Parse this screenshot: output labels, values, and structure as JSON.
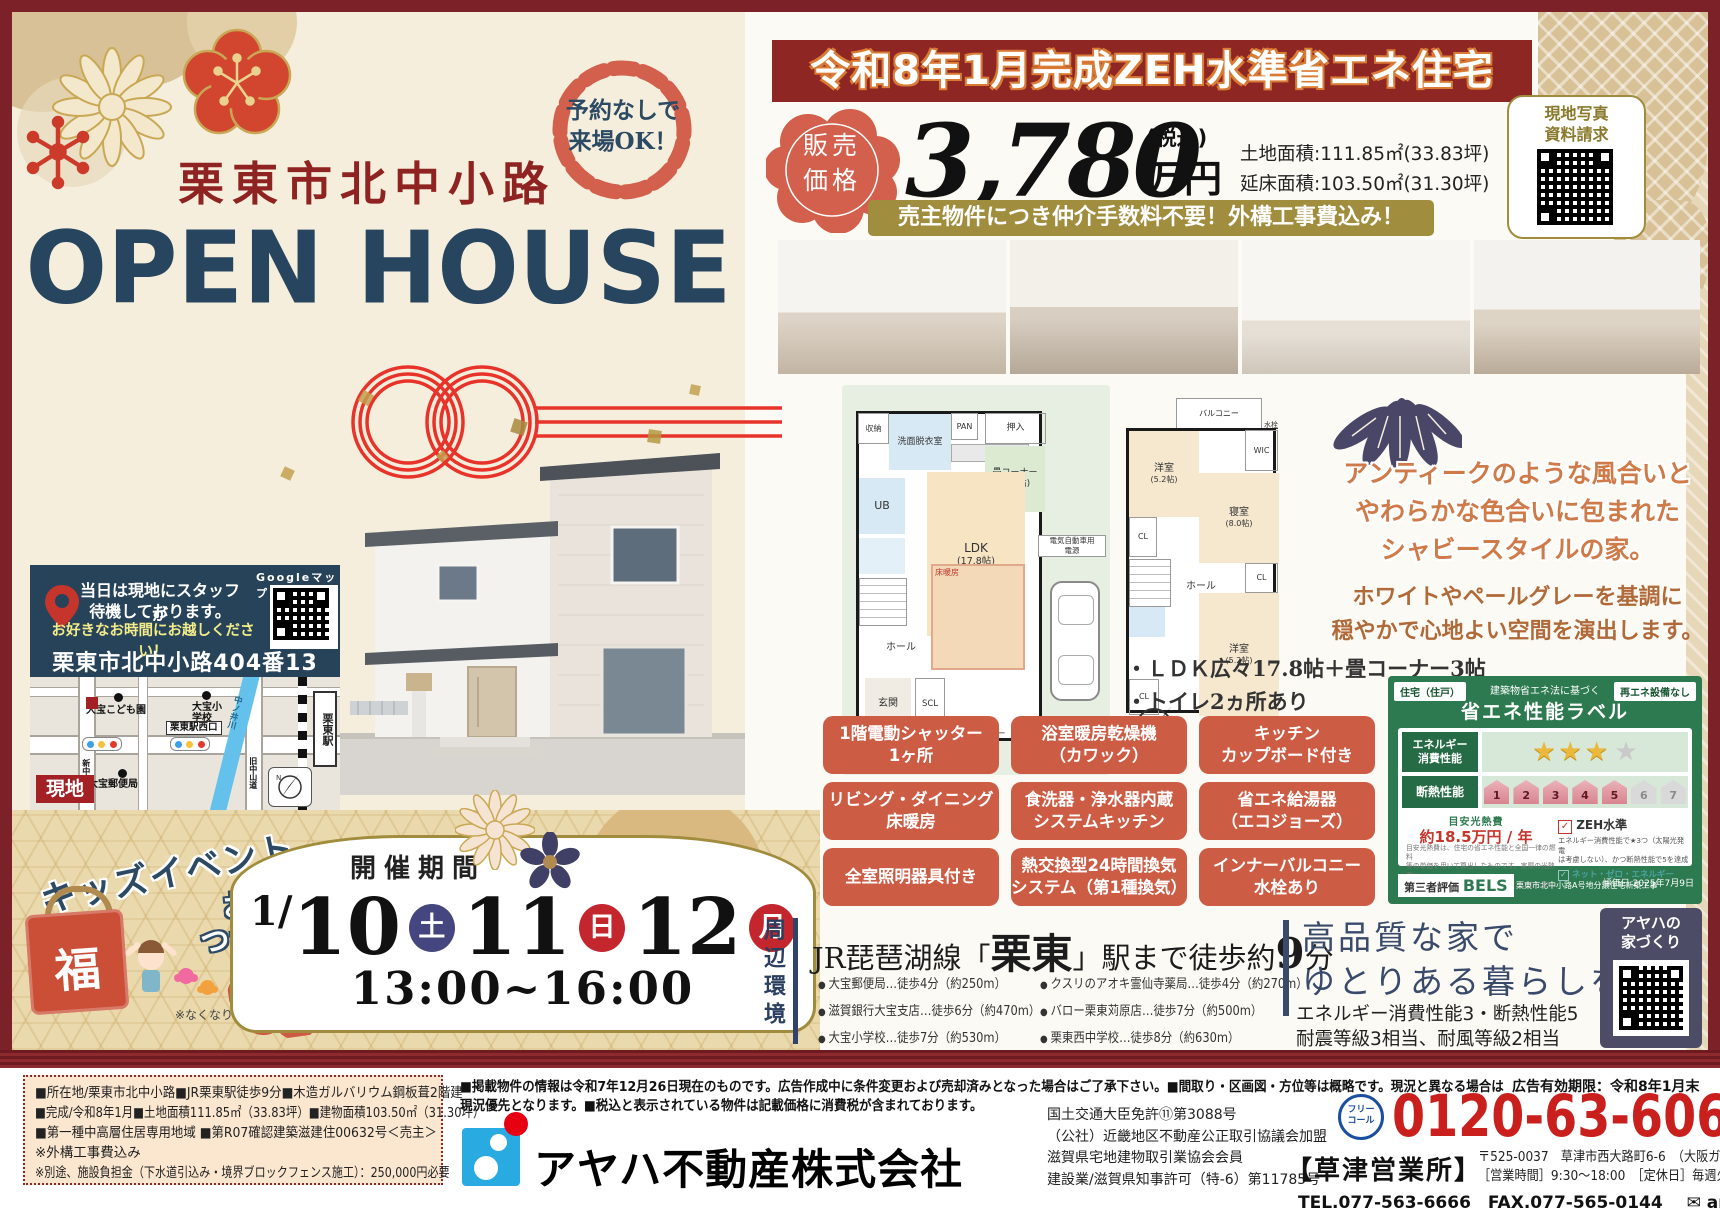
{
  "colors": {
    "frame": "#7c2128",
    "banner_red": "#8e2723",
    "navy": "#29445c",
    "terracotta": "#cd5c45",
    "gold": "#a08c3c",
    "cream": "#f5eedd",
    "label_green": "#2e7a50",
    "phone_red": "#c9201e"
  },
  "left": {
    "badge": {
      "line1": "予約なしで",
      "line2": "来場OK！"
    },
    "location_title": "栗東市北中小路",
    "main_title": "OPEN HOUSE",
    "site_box": {
      "staff1": "当日は現地にスタッフが",
      "staff2": "待機しております。",
      "staff3": "お好きなお時間にお越しください！",
      "address": "栗東市北中小路404番13",
      "google_label": "Googleマップ"
    },
    "map": {
      "kodomoen": "大宝こども園",
      "elementary": "大宝小学校",
      "west_exit": "栗東駅西口",
      "river": "中ノ井川",
      "station": "栗東駅",
      "shin_road": "新中山道",
      "kyu_road": "旧中山道",
      "post_office": "大宝郵便局",
      "genchi": "現地"
    },
    "kids": {
      "title": "キッズイベント",
      "sub1": "お菓子の",
      "sub2": "つかみ取り",
      "fuku": "福",
      "badge1": "3日間",
      "badge2": "限定",
      "note": "※なくなり次第終了となります。"
    },
    "schedule": {
      "heading": "開催期間",
      "month": "1/",
      "d1": "10",
      "w1": "土",
      "d2": "11",
      "w2": "日",
      "d3": "12",
      "w3": "月",
      "time": "13:00~16:00"
    }
  },
  "right": {
    "banner": "令和8年1月完成ZEH水準省エネ住宅",
    "price": {
      "label1": "販売",
      "label2": "価格",
      "amount": "3,780",
      "tax": "(税込)",
      "unit": "万円",
      "land": "土地面積:111.85㎡(33.83坪)",
      "floor": "延床面積:103.50㎡(31.30坪)"
    },
    "qr_card": {
      "line1": "現地写真",
      "line2": "資料請求"
    },
    "gold_banner": "売主物件につき仲介手数料不要！外構工事費込み！",
    "plan1f": {
      "storage": "収納",
      "wash": "洗面脱衣室",
      "pan": "PAN",
      "ub": "UB",
      "tatami1": "畳コーナー",
      "tatami2": "(3.0帖)",
      "ldk1": "LDK",
      "ldk2": "(17.8帖)",
      "yukadan": "床暖房",
      "oshiire": "押入",
      "hall": "ホール",
      "genkan": "玄関",
      "scl": "SCL",
      "shutter": "電動シャッター",
      "ev1": "電気自動車用",
      "ev2": "電源"
    },
    "plan2f": {
      "balcony": "バルコニー",
      "suisen": "水栓",
      "wic": "WIC",
      "yo1a": "洋室",
      "yo1b": "(5.2帖)",
      "bed1": "寝室",
      "bed2": "(8.0帖)",
      "cl": "CL",
      "hall": "ホール",
      "yo2a": "洋室",
      "yo2b": "(5.2帖)"
    },
    "catch": {
      "l1": "アンティークのような風合いと",
      "l2": "やわらかな色合いに包まれた",
      "l3": "シャビースタイルの家。",
      "s1": "ホワイトやペールグレーを基調に",
      "s2": "穏やかで心地よい空間を演出します。"
    },
    "points": {
      "p1": "・ＬＤＫ広々17.8帖＋畳コーナー3帖",
      "p2": "・トイレ2ヵ所あり"
    },
    "features": [
      {
        "l1": "1階電動シャッター",
        "l2": "1ヶ所"
      },
      {
        "l1": "浴室暖房乾燥機",
        "l2": "（カワック）"
      },
      {
        "l1": "キッチン",
        "l2": "カップボード付き"
      },
      {
        "l1": "リビング・ダイニング",
        "l2": "床暖房"
      },
      {
        "l1": "食洗器・浄水器内蔵",
        "l2": "システムキッチン"
      },
      {
        "l1": "省エネ給湯器",
        "l2": "（エコジョーズ）"
      },
      {
        "l1": "全室照明器具付き",
        "l2": ""
      },
      {
        "l1": "熱交換型24時間換気",
        "l2": "システム（第1種換気）"
      },
      {
        "l1": "インナーバルコニー",
        "l2": "水栓あり"
      }
    ],
    "energy": {
      "tab_left": "住宅（住戸）",
      "tab_right": "再エネ設備なし",
      "head_small": "建築物省エネ法に基づく",
      "head": "省エネ性能ラベル",
      "e1": "エネルギー",
      "e2": "消費性能",
      "row2_label": "断熱性能",
      "stars_filled": "★★★",
      "stars_empty": "★",
      "houses": [
        "1",
        "2",
        "3",
        "4",
        "5",
        "6",
        "7"
      ],
      "cost_head": "目安光熱費",
      "cost": "約18.5万円 / 年",
      "check": "✓",
      "zeh": "ZEH水準",
      "zeh_note1": "エネルギー消費性能で★3つ（太陽光発電",
      "zeh_note2": "は考慮しない）、かつ断熱性能で5を達成",
      "nze": "ネット・ゼロ・エネルギー",
      "fine1": "目安光熱費は、住宅の省エネ性能と全国一律の燃料",
      "fine2": "等の単価を用いて算出したものです。実際の光熱費は、",
      "fine3": "使用条件や設備、契約会社・方法などにより異なります。",
      "bels_label": "第三者評価",
      "bels": "BELS",
      "bels_note": "栗東市北中小路A号地分譲住宅新築工事",
      "bels_date": "評価日 2025年7月9日"
    },
    "access": {
      "side": "周辺環境",
      "h1": "JR琵琶湖線「",
      "h2": "栗東",
      "h3": "」駅まで徒歩約",
      "h4": "9",
      "h5": "分",
      "items": [
        "大宝郵便局…徒歩4分（約250m）",
        "クスリのアオキ霊仙寺薬局…徒歩4分（約270m）",
        "滋賀銀行大宝支店…徒歩6分（約470m）",
        "バロー栗東苅原店…徒歩7分（約500m）",
        "大宝小学校…徒歩7分（約530m）",
        "栗東西中学校…徒歩8分（約630m）"
      ]
    },
    "quality": {
      "t1": "高品質な家で",
      "t2": "ゆとりある暮らしを",
      "s1": "エネルギー消費性能3・断熱性能5",
      "s2": "耐震等級3相当、耐風等級2相当",
      "qr1": "アヤハの",
      "qr2": "家づくり"
    }
  },
  "footer": {
    "details": [
      "■所在地/栗東市北中小路■JR栗東駅徒歩9分■木造ガルバリウム鋼板葺2階建",
      "■完成/令和8年1月■土地面積111.85㎡（33.83坪）■建物面積103.50㎡（31.30坪）",
      "■第一種中高層住居専用地域 ■第R07確認建築滋建住00632号＜売主＞",
      "※外構工事費込み",
      "※別途、施設負担金（下水道引込み・境界ブロックフェンス施工）：250,000円必要"
    ],
    "disclaimer1": "■掲載物件の情報は令和7年12月26日現在のものです。広告作成中に条件変更および売却済みとなった場合はご了承下さい。■間取り・区画図・方位等は概略です。現況と異なる場合は",
    "disclaimer2": "現況優先となります。■税込と表示されている物件は記載価格に消費税が含まれております。",
    "company": "アヤハ不動産株式会社",
    "licenses": [
      "国土交通大臣免許⑪第3088号",
      "（公社）近畿地区不動産公正取引協議会加盟",
      "滋賀県宅地建物取引業協会会員",
      "建設業/滋賀県知事許可（特-6）第11785号"
    ],
    "ad_expiry": "広告有効期限：令和8年1月末",
    "free1": "フリー",
    "free2": "コール",
    "phone": "0120-63-6066",
    "office": "【草津営業所】",
    "office_addr": "〒525-0037　草津市西大路町6-6　（大阪ガス隣）",
    "office_hours": "［営業時間］9:30～18:00　［定休日］毎週火曜・水曜",
    "tel_fax": "TEL.077-563-6666　FAX.077-565-0144",
    "mail_icon": "✉",
    "email": "arnet-ks@ayaha.co.jp"
  }
}
